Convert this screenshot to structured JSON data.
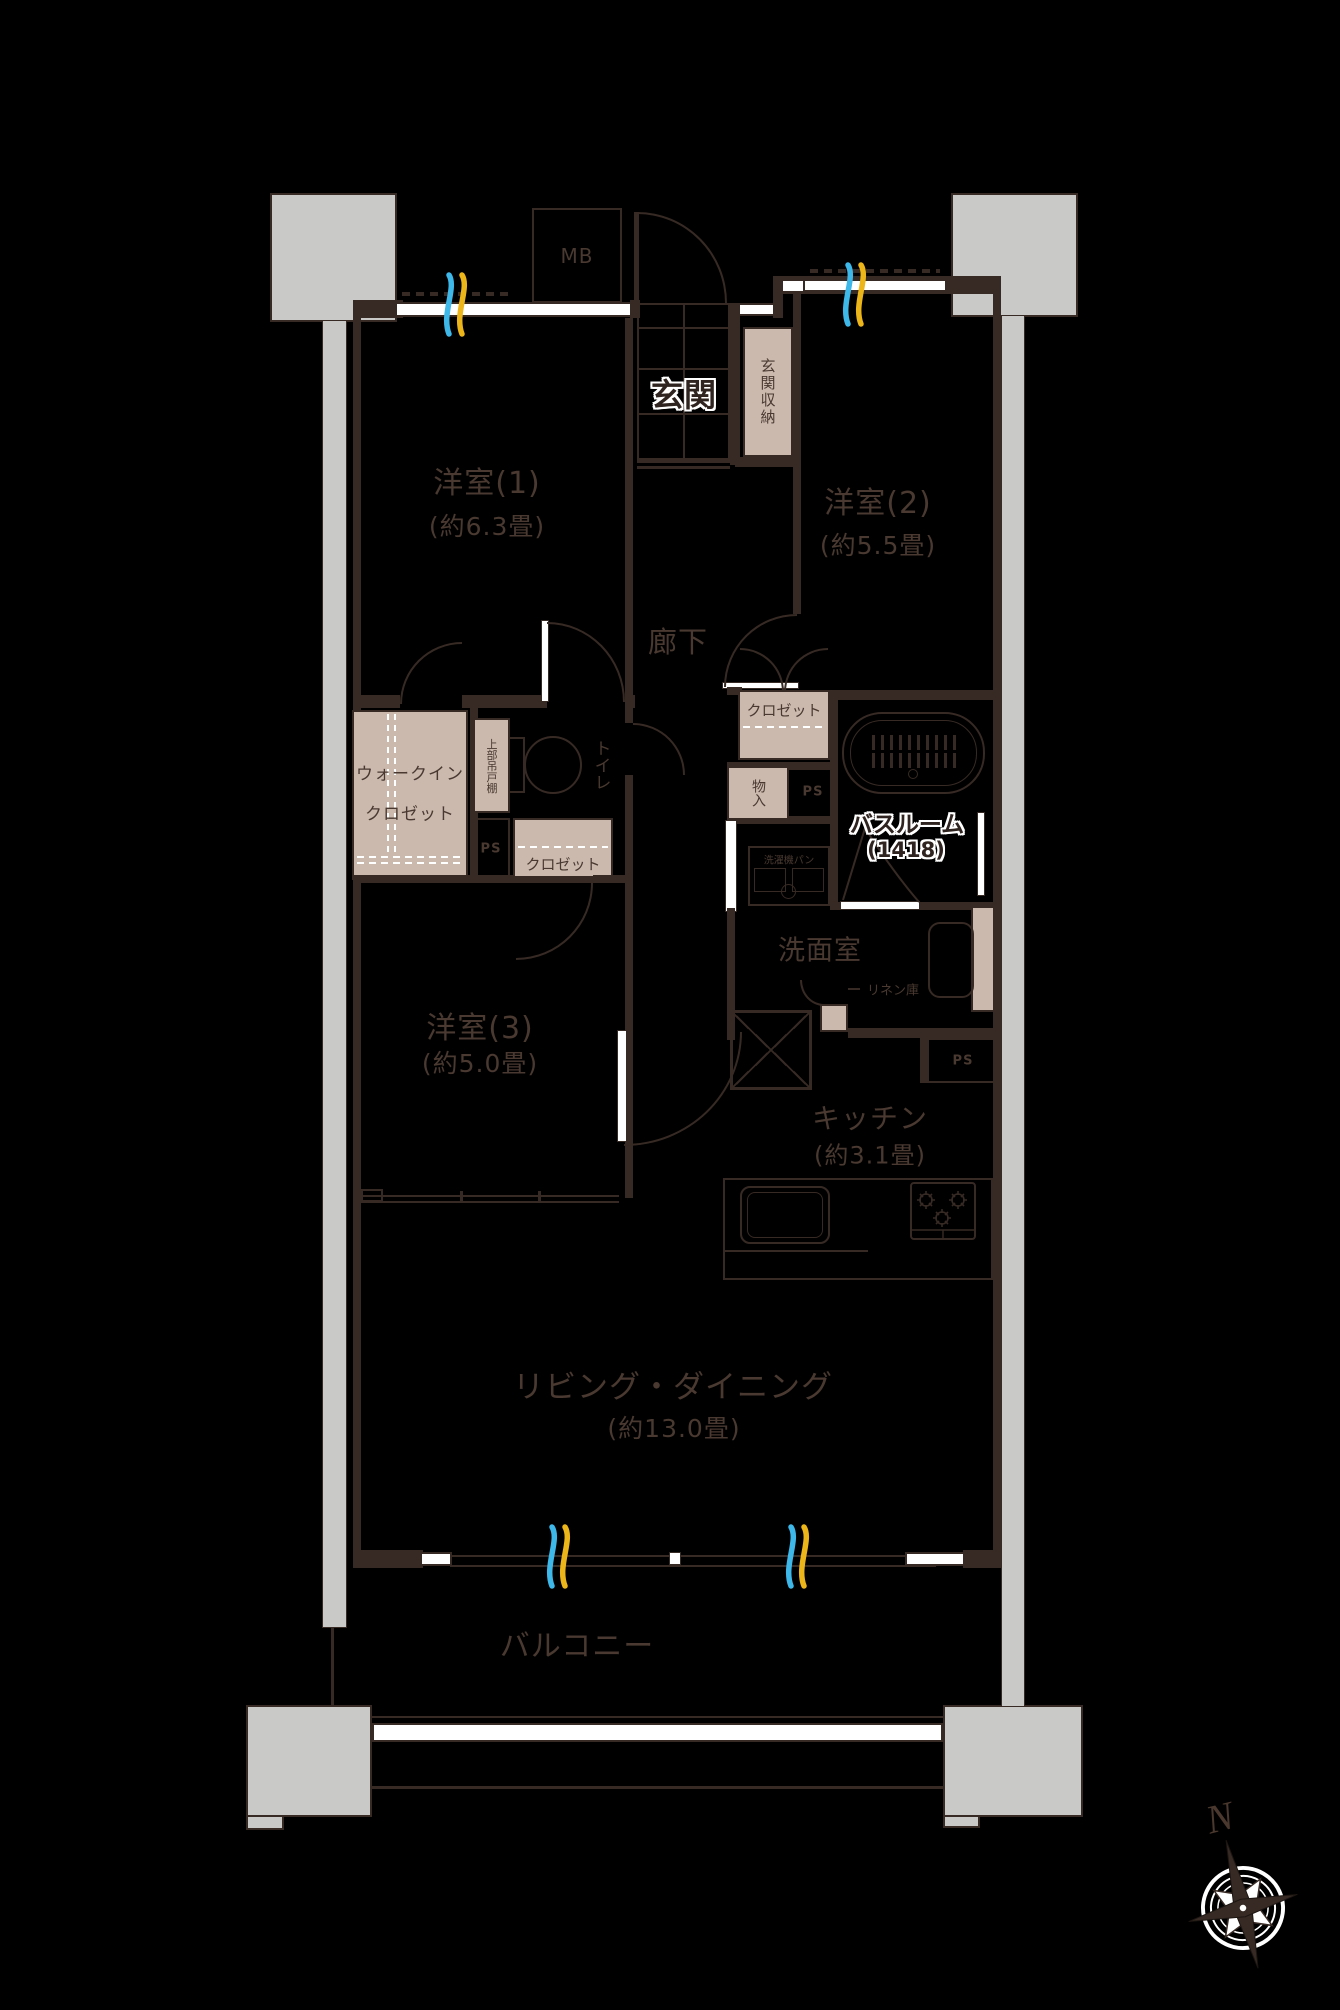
{
  "floorplan": {
    "rooms": {
      "room1": {
        "name": "洋室(1)",
        "size": "(約6.3畳)"
      },
      "room2": {
        "name": "洋室(2)",
        "size": "(約5.5畳)"
      },
      "room3": {
        "name": "洋室(3)",
        "size": "(約5.0畳)"
      },
      "living_dining": {
        "name": "リビング・ダイニング",
        "size": "(約13.0畳)"
      },
      "kitchen": {
        "name": "キッチン",
        "size": "(約3.1畳)"
      },
      "genkan": {
        "name": "玄関"
      },
      "bathroom": {
        "name": "バスルーム",
        "size": "(1418)"
      },
      "washroom": {
        "name": "洗面室"
      },
      "corridor": {
        "name": "廊下"
      },
      "toilet": {
        "name": "トイレ"
      },
      "balcony": {
        "name": "バルコニー"
      }
    },
    "storage": {
      "genkan_storage": "玄関収納",
      "wic_line1": "ウォークイン",
      "wic_line2": "クロゼット",
      "upper_cabinet": "上部吊戸棚",
      "closet_room3": "クロゼット",
      "closet_room2": "クロゼット",
      "monoire": "物入",
      "linen": "リネン庫",
      "washer_pan": "洗濯機パン"
    },
    "utility": {
      "mb": "MB",
      "ps": "PS"
    },
    "compass": {
      "north": "N"
    },
    "colors": {
      "background": "#000000",
      "wall": "#372a24",
      "fill_tan": "#cbb9ae",
      "pillar_gray": "#c9cac8",
      "window_blue": "#3eb7e9",
      "window_yellow": "#ecb519",
      "label": "#493930"
    }
  }
}
